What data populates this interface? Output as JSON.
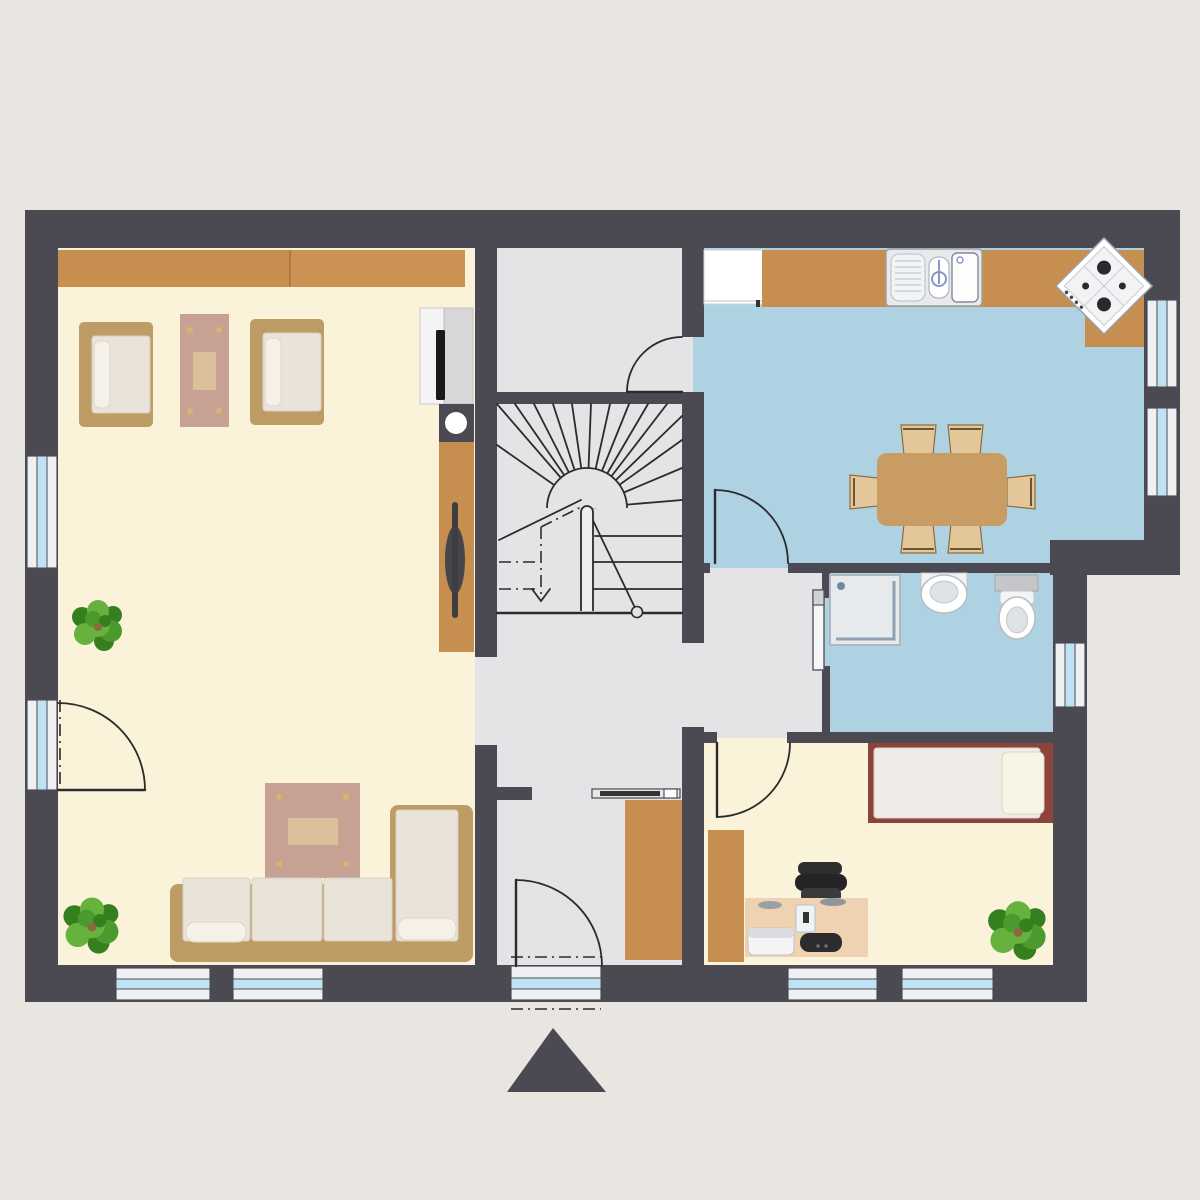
{
  "meta": {
    "kind": "architectural floor plan, top-down, no text labels",
    "rooms": [
      "living-room",
      "vestibule",
      "stairwell",
      "hallway",
      "kitchen",
      "bathroom",
      "bedroom-office"
    ],
    "window_count": 9,
    "door_count": 6
  },
  "colors": {
    "page-bg": "#e9e6e1",
    "wall": "#4b4a52",
    "line": "#2b2b2e",
    "floor-cream": "#faf3da",
    "floor-blue": "#afd2e2",
    "floor-gray": "#e4e4e6",
    "wood": "#c68e4f",
    "wood-light": "#cb9254",
    "sofa-tan": "#bd9c66",
    "cushion": "#e9e3d9",
    "pillow": "#f6f1e8",
    "pink-table": "#c7a294",
    "table-inlay": "#dcc09b",
    "table-dot": "#d9b46d",
    "dining-table": "#c89c62",
    "chair-tan": "#e3c79b",
    "glass": "#bfe3f5",
    "frame-white": "#eef0f2",
    "bed-frame": "#8c443a",
    "mattress": "#efece8",
    "desk": "#eed2b2",
    "dark-item": "#2c2c2e",
    "plant-green": "#4c9a2e",
    "plant-green2": "#67b13e",
    "plant-green3": "#357f1f"
  }
}
